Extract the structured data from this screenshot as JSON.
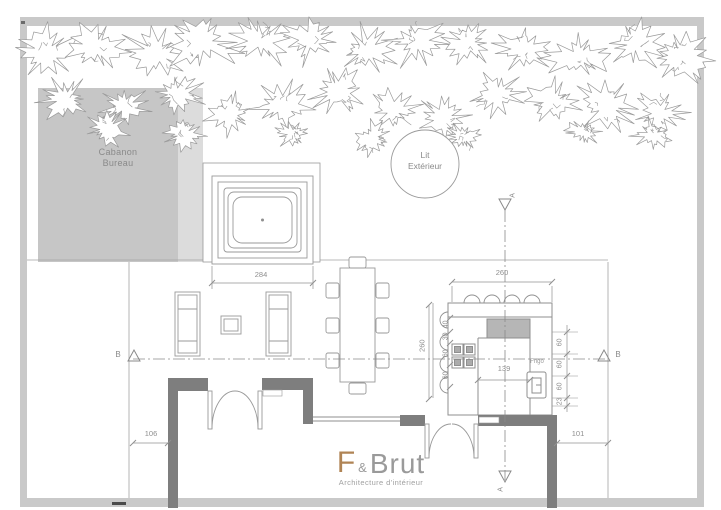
{
  "labels": {
    "cabanon": {
      "line1": "Cabanon",
      "line2": "Bureau"
    },
    "outdoor_bed": {
      "line1": "Lit",
      "line2": "Extérieur"
    },
    "fridge": "Frigo"
  },
  "dimensions": {
    "spa_terrace_width": "284",
    "kitchen_width": "260",
    "kitchen_depth": "260",
    "kitchen_left_segments": [
      "40",
      "30",
      "60",
      "60"
    ],
    "kitchen_right_segments": [
      "60",
      "60",
      "60",
      "23"
    ],
    "kitchen_inner_width": "139",
    "left_setback": "106",
    "right_setback": "101"
  },
  "section_markers": {
    "a": "A",
    "b": "B"
  },
  "logo": {
    "mark": "F",
    "ampersand": "&",
    "name": "Brut",
    "subtitle": "Architecture d'intérieur"
  },
  "colors": {
    "wall": "#7e7e7e",
    "frame": "#c9c9c9",
    "cabanon_fill": "#c6c6c6",
    "hood_fill": "#b6b6b6",
    "line": "#9a9a9a",
    "logo_accent": "#b08455",
    "text": "#8a8a8a"
  }
}
